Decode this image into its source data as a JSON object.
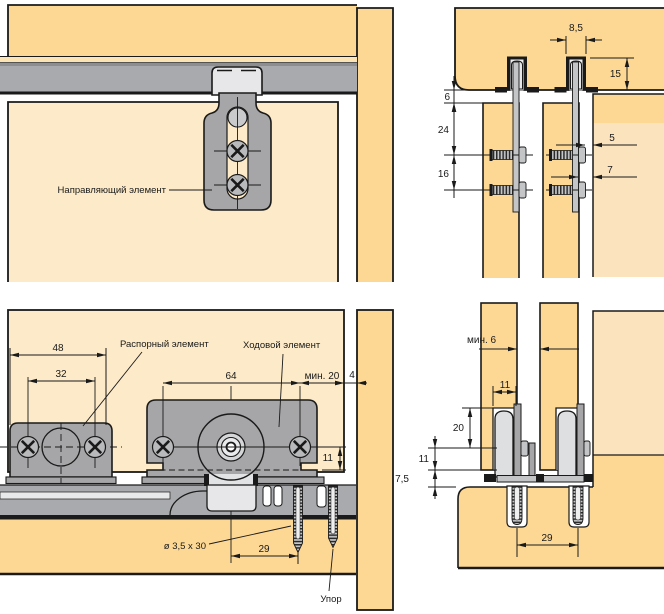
{
  "colors": {
    "wood": "#FDD894",
    "wood-pale": "#FDEAC8",
    "wood-soft": "#FAE3BD",
    "strip-tan": "#FCE4B4",
    "rail": "#A8AAAD",
    "rail-dark": "#8E8E90",
    "metal": "#A6A6A8",
    "metal-mid": "#C4C5C7",
    "metal-light": "#E7E7E9",
    "wheel": "#DEDFE1",
    "screw-face": "#B9BABC",
    "ink": "#1A1A1A"
  },
  "views": {
    "top_left": {
      "guide_label": "Направляющий элемент"
    },
    "top_right": {
      "dims": {
        "d85": "8,5",
        "d15": "15",
        "d6": "6",
        "d24": "24",
        "d16": "16",
        "d5": "5",
        "d7": "7"
      }
    },
    "bottom_left": {
      "spacer_label": "Распорный элемент",
      "runner_label": "Ходовой элемент",
      "screw_label": "ø 3,5 x 30",
      "stop_label": "Упор",
      "dims": {
        "d48": "48",
        "d32": "32",
        "d64": "64",
        "dmin20": "мин. 20",
        "d4": "4",
        "d11": "11",
        "d29": "29"
      }
    },
    "bottom_right": {
      "dims": {
        "dmin6": "мин. 6",
        "d11_top": "11",
        "d20": "20",
        "d11_left": "11",
        "d75": "7,5",
        "d29": "29"
      }
    }
  }
}
